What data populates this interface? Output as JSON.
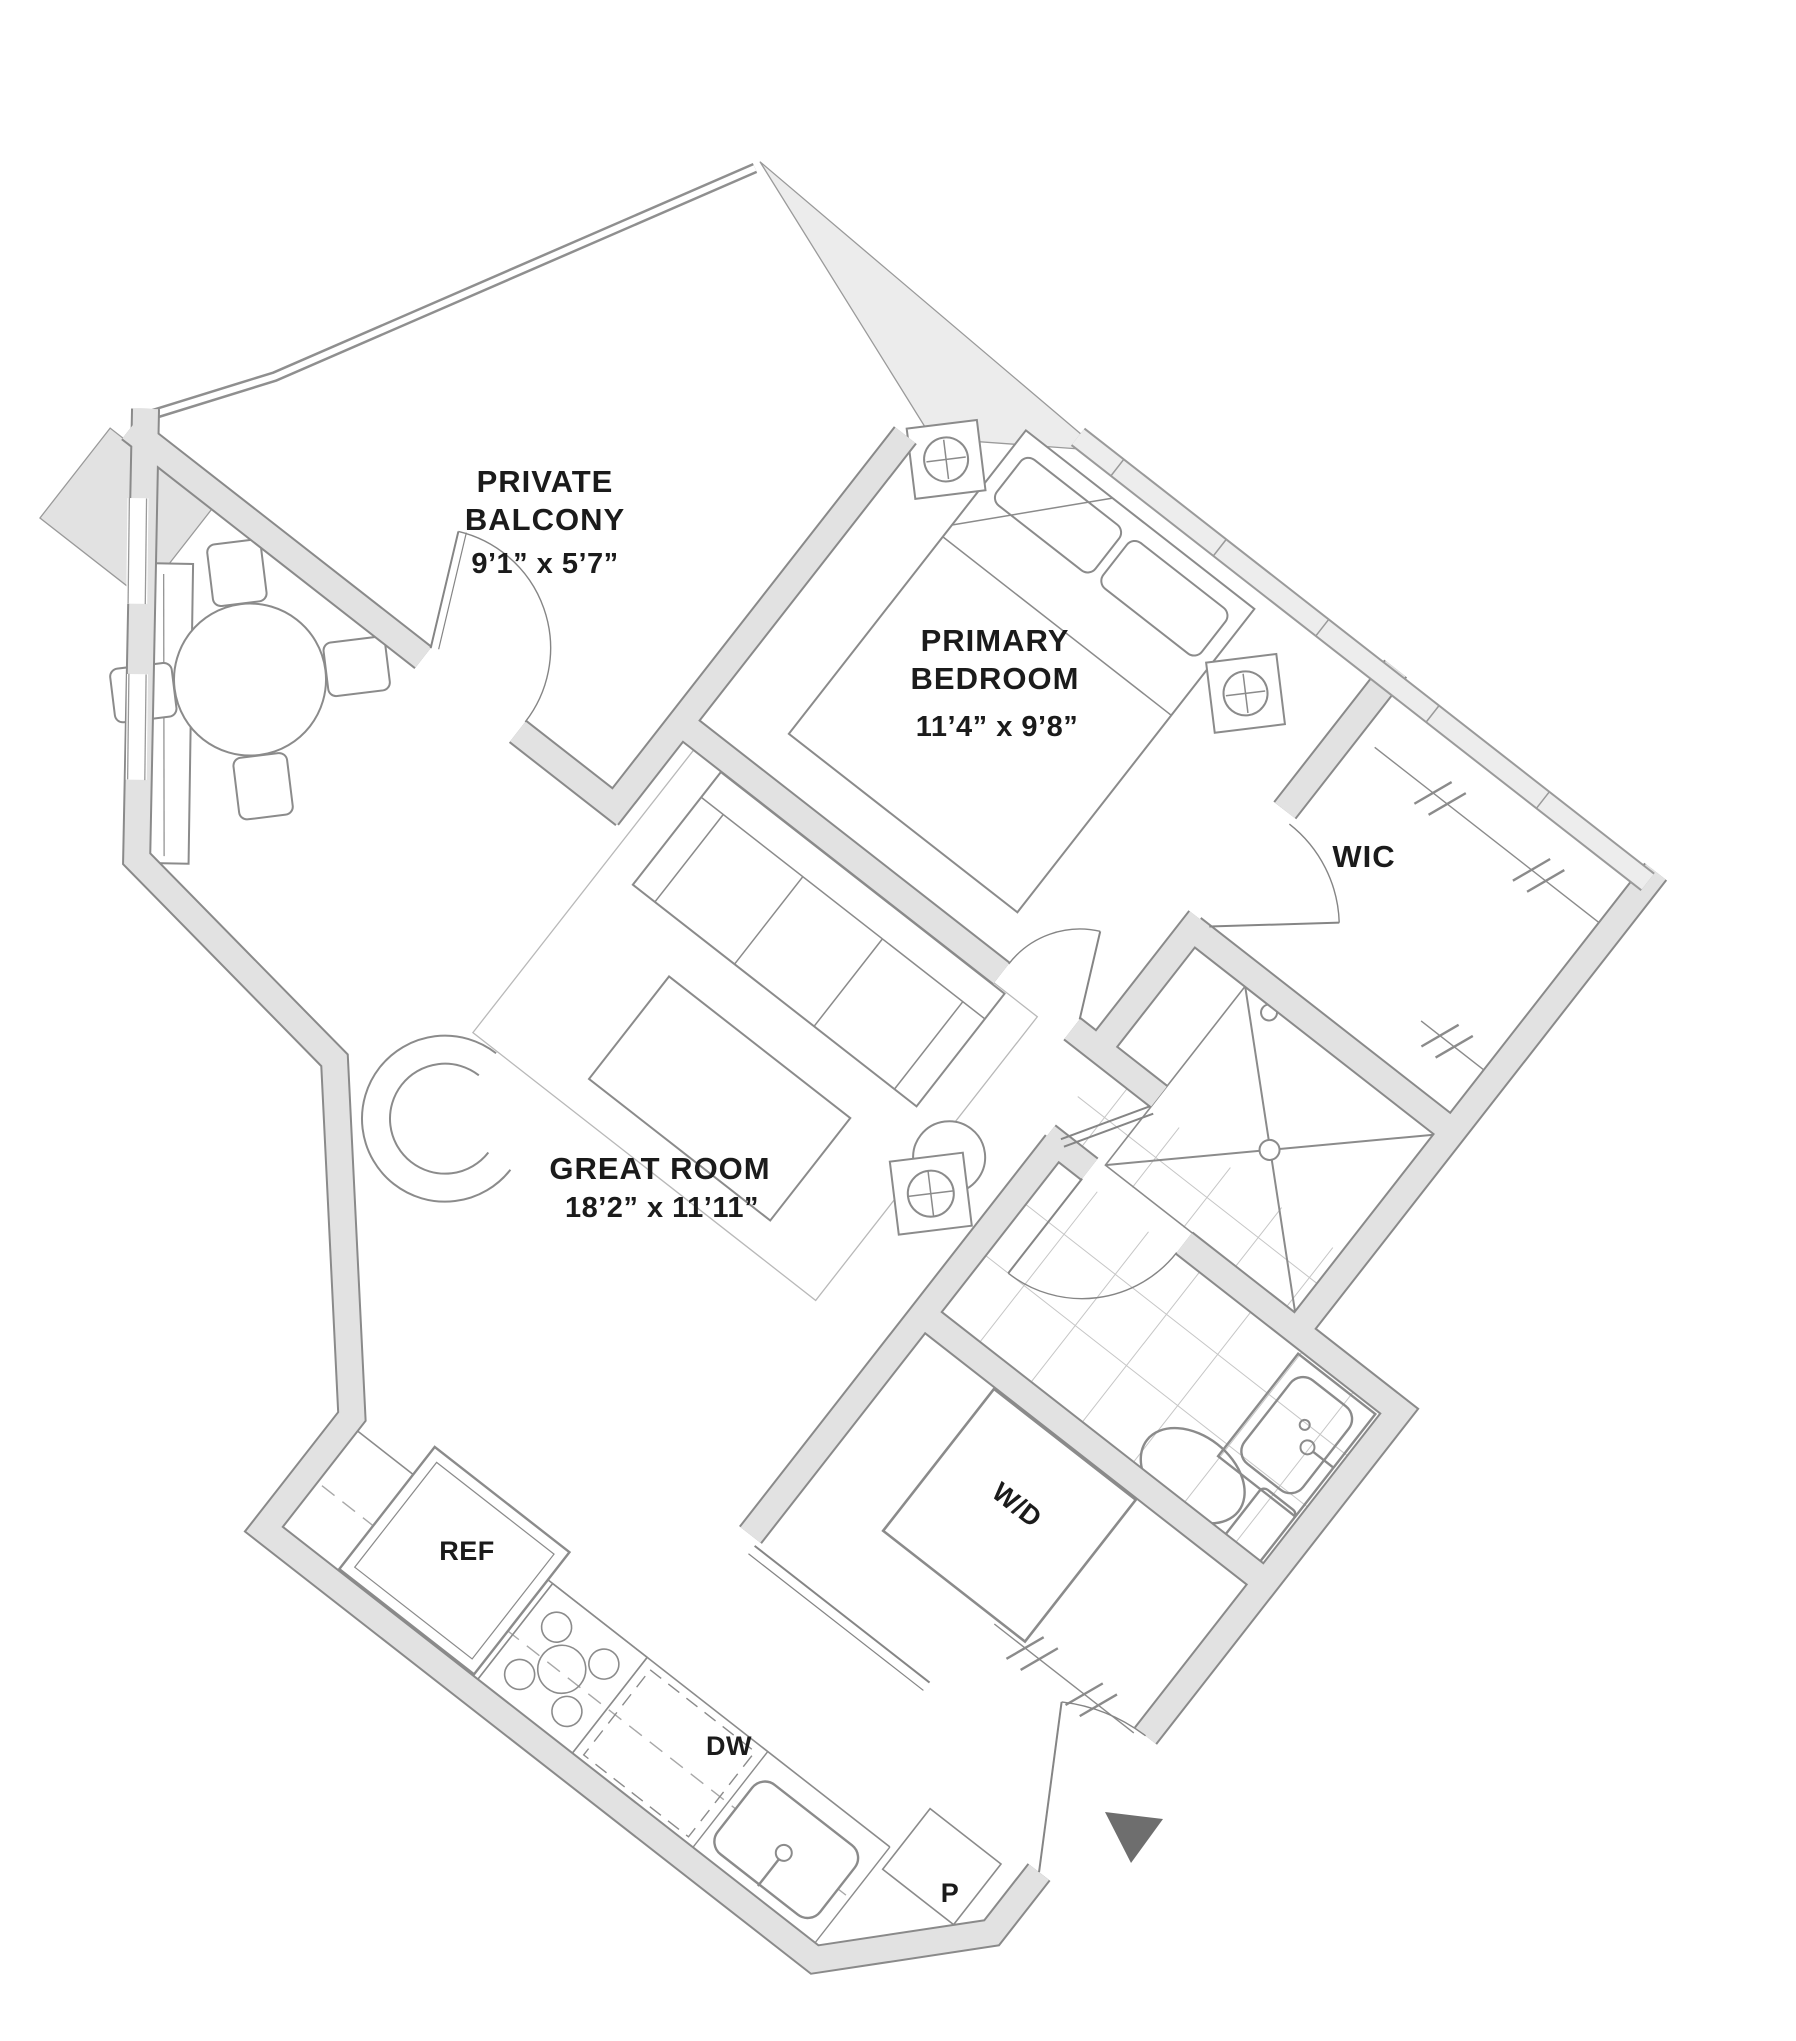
{
  "title": "One-bedroom apartment floor plan",
  "rooms": {
    "balcony": {
      "line1": "PRIVATE",
      "line2": "BALCONY",
      "dims": "9’1” x 5’7”"
    },
    "primary_bedroom": {
      "line1": "PRIMARY",
      "line2": "BEDROOM",
      "dims": "11’4” x 9’8”"
    },
    "wic": {
      "label": "WIC"
    },
    "great_room": {
      "label": "GREAT ROOM",
      "dims": "18’2” x 11’11”"
    },
    "laundry": {
      "label": "W/D"
    },
    "kitchen": {
      "ref": "REF",
      "dishwasher": "DW",
      "pantry": "P"
    }
  },
  "icons": {
    "entry_arrow": "entry-direction-arrow",
    "lamp": "table-lamp-circle-x",
    "shower": "shower-x",
    "closet_rod": "hanging-rod-slashes"
  },
  "colors": {
    "wall_fill": "#e2e2e2",
    "wall_edge": "#8a8a8a",
    "window_band": "#ededed",
    "exterior_shade": "#ececec",
    "furniture_line": "#8b8b8b",
    "tile_line": "#c6c6c6",
    "label_text": "#1b1b1b",
    "entry_arrow": "#6e6e6e"
  }
}
